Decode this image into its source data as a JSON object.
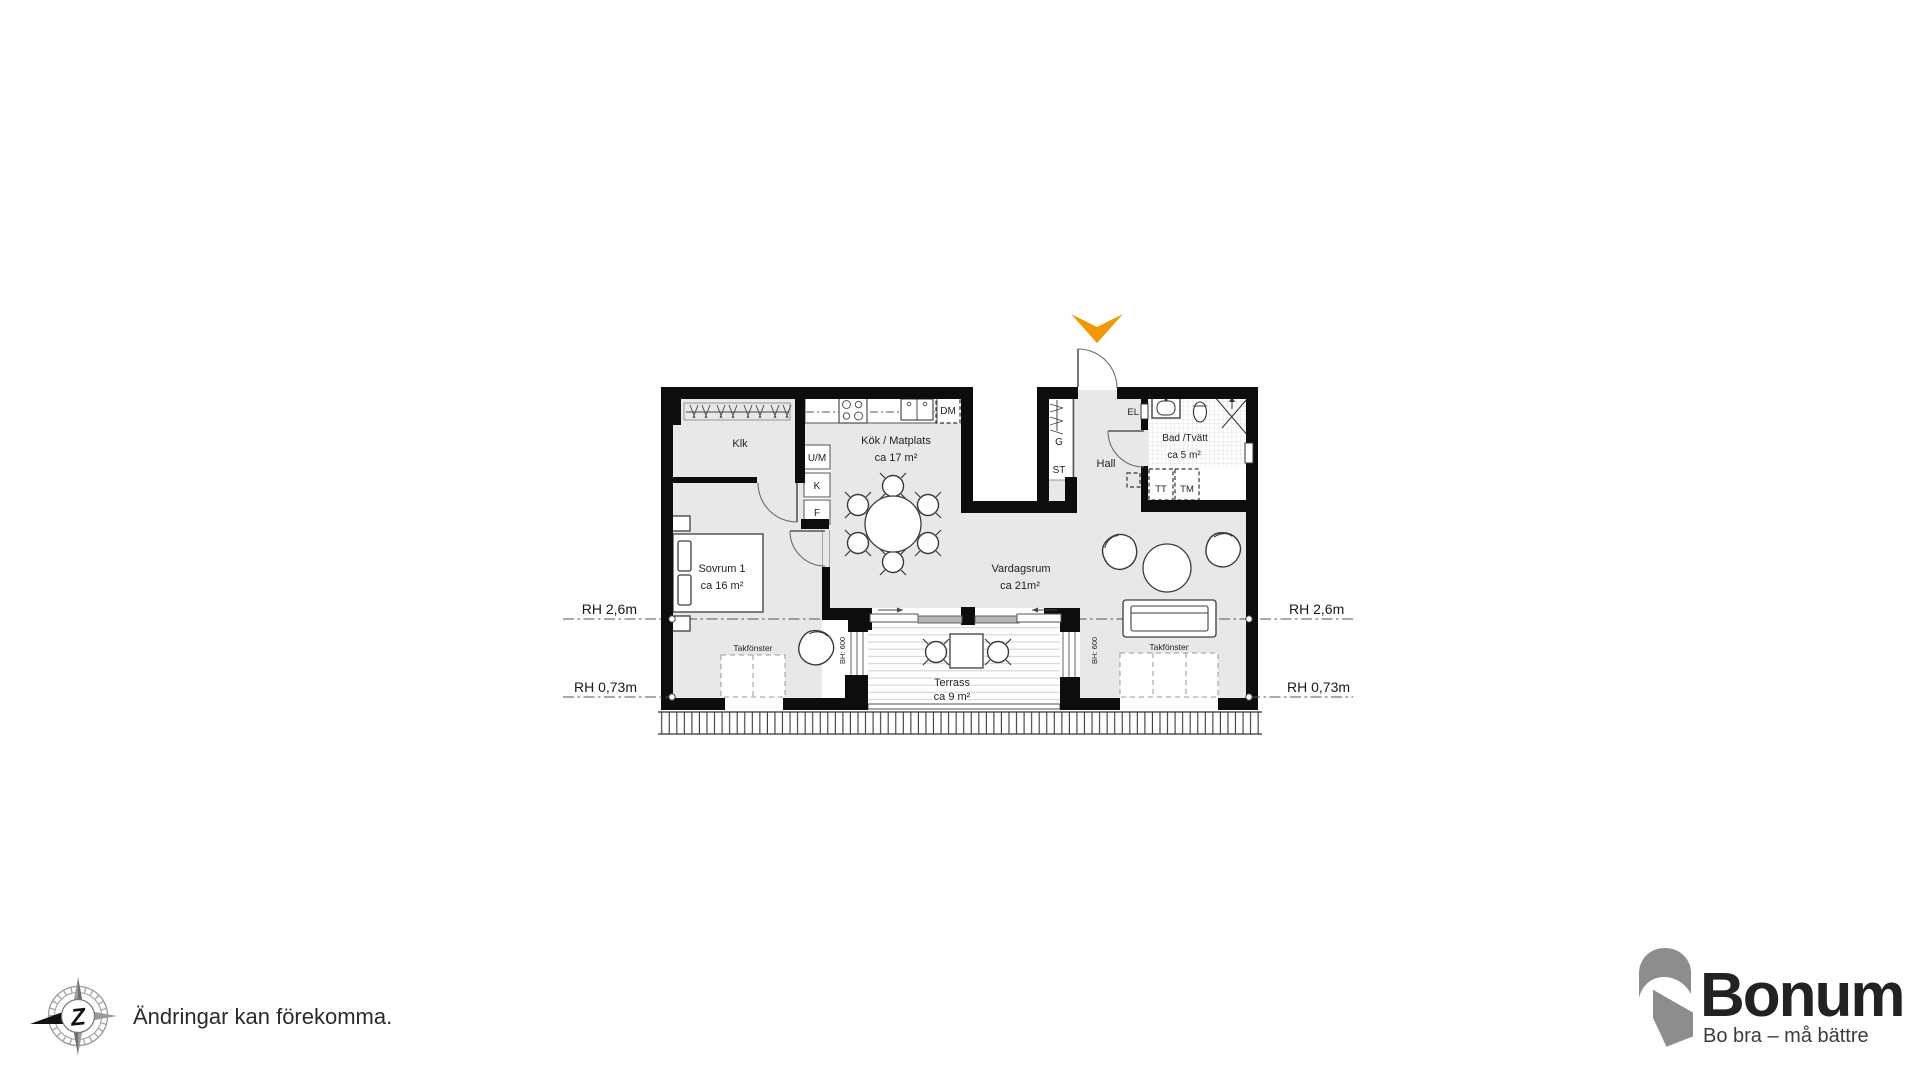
{
  "plan": {
    "rooms": {
      "klk": {
        "label": "Klk"
      },
      "kitchen": {
        "label": "Kök / Matplats",
        "area": "ca 17 m²"
      },
      "bedroom": {
        "label": "Sovrum 1",
        "area": "ca 16 m²"
      },
      "living": {
        "label": "Vardagsrum",
        "area": "ca 21m²"
      },
      "hall": {
        "label": "Hall"
      },
      "bath": {
        "label": "Bad /Tvätt",
        "area": "ca 5 m²"
      },
      "terrace": {
        "label": "Terrass",
        "area": "ca 9 m²"
      }
    },
    "fixtures": {
      "oven_micro": "U/M",
      "fridge": "K",
      "freezer": "F",
      "dishwasher": "DM",
      "wardrobe_cabinet": "G",
      "cleaning_cabinet": "ST",
      "electrical_cabinet": "EL",
      "dryer": "TT",
      "washer": "TM"
    },
    "annotations": {
      "skylight": "Takfönster",
      "window_sill_height": "BH: 600",
      "room_height_upper": "RH 2,6m",
      "room_height_lower": "RH 0,73m"
    }
  },
  "footer": {
    "disclaimer": "Ändringar kan förekomma.",
    "compass_letter": "Z"
  },
  "logo": {
    "brand": "Bonum",
    "tagline": "Bo bra – må bättre"
  },
  "colors": {
    "accent_orange": "#F49600",
    "logo_orange": "#F28D00",
    "logo_gray": "#8D8D8D",
    "wall_black": "#0D0D0D",
    "floor_gray": "#E8E8E8"
  }
}
